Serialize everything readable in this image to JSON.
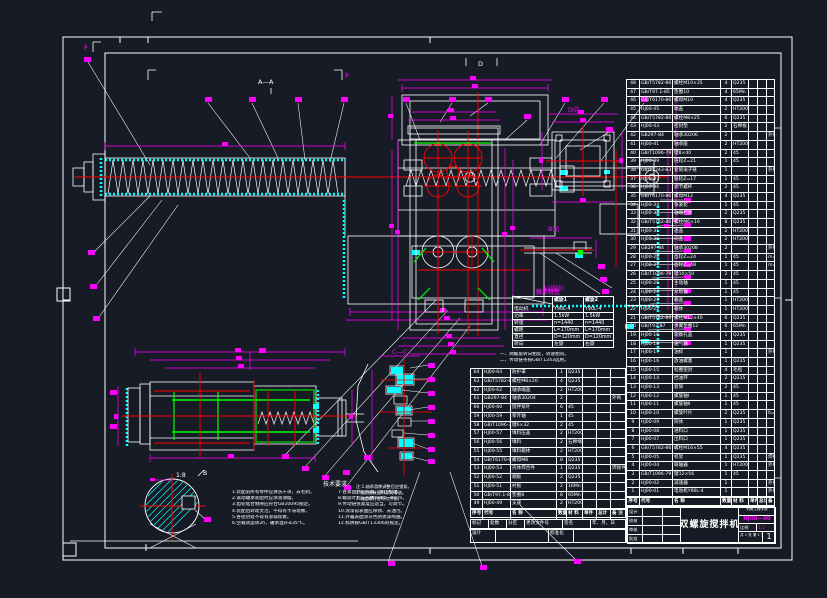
{
  "labels": {
    "section_aa": "A—A",
    "view_d_arrow": "D",
    "view_d": "D向",
    "view_b": "B向",
    "section_cc": "C—C",
    "section_f_left": "F",
    "section_f_right": "F",
    "detail_scale": "1:8",
    "view_b_mark": "B",
    "sprocket_caption": "主动链轮"
  },
  "colors": {
    "background": "#161b26",
    "line": "#ffffff",
    "dimension": "#ff00ff",
    "hatch": "#00ffff",
    "centerline": "#ff0000",
    "highlight": "#00ff00"
  },
  "tech_table": {
    "title": "技术特性",
    "header": [
      "",
      "螺旋1",
      "螺旋2"
    ],
    "rows": [
      [
        "电动机",
        "Y90L-4",
        "Y90L-4"
      ],
      [
        "功率",
        "1.5kW",
        "1.5kW"
      ],
      [
        "转速",
        "n=1440",
        "n=1440"
      ],
      [
        "螺距",
        "L=170mm",
        "L=170mm"
      ],
      [
        "直径",
        "D=120mm",
        "D=120mm"
      ],
      [
        "转向",
        "左旋",
        "右旋"
      ]
    ],
    "notes": [
      "一、两螺旋转向相反，转速相同。",
      "二、传动链条按GB/T1243选用。"
    ]
  },
  "tech_req": {
    "title": "技术要求",
    "left": [
      "1.装配前所有零件应清洗干净，去毛刺。",
      "2.滚动轴承装配时应涂润滑脂。",
      "3.齿轮啮合侧隙应符合GB10095规定。",
      "4.装配后转动灵活，不得有卡滞现象。",
      "5.各密封处不得有渗漏现象。",
      "6.空载试运转2h，轴承温升≤35℃。"
    ],
    "right": [
      "7.各紧固件应拧紧，防止松动。",
      "8.螺旋叶片与壳体间隙5~8mm。",
      "9.传动链张紧度应适当，可调节。",
      "10.涂漆前表面应除锈、去油污。",
      "11.外露表面涂灰色防锈漆两遍。",
      "12.标牌按GB/T13306的规定。"
    ]
  },
  "cc_notes": [
    "注:1.轴承游隙调整后应锁紧。",
    "2.密封圈装配时涂润滑油。",
    "3.端盖螺钉应均匀拧紧。"
  ],
  "tables": {
    "headers": [
      "序号",
      "代号",
      "名  称",
      "数量",
      "材 料",
      "单件",
      "总计",
      "备 注"
    ],
    "bom_right": {
      "rows": [
        [
          "48",
          "GB/T5782-86",
          "螺栓M10×35",
          "4",
          "Q235",
          "",
          "",
          ""
        ],
        [
          "47",
          "GB/T97.1-85",
          "垫圈10",
          "4",
          "65Mn",
          "",
          "",
          ""
        ],
        [
          "46",
          "GB/T6170-86",
          "螺母M10",
          "4",
          "Q235",
          "",
          "",
          ""
        ],
        [
          "45",
          "HJ00-45",
          "端盖",
          "2",
          "HT200",
          "",
          "",
          ""
        ],
        [
          "44",
          "GB/T5782-86",
          "螺栓M8×25",
          "6",
          "Q235",
          "",
          "",
          ""
        ],
        [
          "43",
          "HJ00-43",
          "密封垫",
          "2",
          "石棉板",
          "",
          "",
          ""
        ],
        [
          "42",
          "GB297-84",
          "轴承30206",
          "2",
          "",
          "",
          "",
          "外购"
        ],
        [
          "41",
          "HJ00-41",
          "轴承座",
          "2",
          "HT200",
          "",
          "",
          ""
        ],
        [
          "40",
          "GB/T1096-79",
          "键8×40",
          "2",
          "45",
          "",
          "",
          ""
        ],
        [
          "39",
          "HJ00-39",
          "链轮Z=21",
          "1",
          "45",
          "",
          "",
          ""
        ],
        [
          "38",
          "GB/T1243-83",
          "套筒滚子链",
          "1",
          "",
          "",
          "",
          "外购"
        ],
        [
          "37",
          "HJ00-37",
          "链轮Z=17",
          "1",
          "45",
          "",
          "",
          ""
        ],
        [
          "36",
          "HJ00-36",
          "调节螺杆",
          "2",
          "45",
          "",
          "",
          ""
        ],
        [
          "35",
          "GB/T6170-86",
          "螺母M12",
          "4",
          "Q235",
          "",
          "",
          ""
        ],
        [
          "34",
          "HJ00-34",
          "张紧轮",
          "1",
          "45",
          "",
          "",
          ""
        ],
        [
          "33",
          "HJ00-33",
          "轴端挡圈",
          "2",
          "Q235",
          "",
          "",
          ""
        ],
        [
          "32",
          "GB/T5782-86",
          "螺栓M6×16",
          "8",
          "Q235",
          "",
          "",
          ""
        ],
        [
          "31",
          "HJ00-31",
          "透盖",
          "2",
          "HT200",
          "",
          "",
          ""
        ],
        [
          "30",
          "HJ00-30",
          "闷盖",
          "2",
          "HT200",
          "",
          "",
          ""
        ],
        [
          "29",
          "GB297-84",
          "轴承30208",
          "2",
          "",
          "",
          "",
          "外购"
        ],
        [
          "28",
          "HJ00-28",
          "齿轮Z=24",
          "1",
          "45",
          "",
          "",
          "m=3"
        ],
        [
          "27",
          "HJ00-27",
          "齿轮Z=48",
          "1",
          "45",
          "",
          "",
          "m=3"
        ],
        [
          "26",
          "GB/T1096-79",
          "键10×50",
          "2",
          "45",
          "",
          "",
          ""
        ],
        [
          "25",
          "HJ00-25",
          "主动轴",
          "1",
          "45",
          "",
          "",
          ""
        ],
        [
          "24",
          "HJ00-24",
          "从动轴",
          "1",
          "45",
          "",
          "",
          ""
        ],
        [
          "23",
          "HJ00-23",
          "箱盖",
          "1",
          "HT200",
          "",
          "",
          ""
        ],
        [
          "22",
          "HJ00-22",
          "箱体",
          "1",
          "HT200",
          "",
          "",
          ""
        ],
        [
          "21",
          "GB/T5782-86",
          "螺栓M12×40",
          "6",
          "Q235",
          "",
          "",
          ""
        ],
        [
          "20",
          "GB/T93-87",
          "弹簧垫圈12",
          "6",
          "65Mn",
          "",
          "",
          ""
        ],
        [
          "19",
          "HJ00-19",
          "观察孔盖",
          "1",
          "Q235",
          "",
          "",
          ""
        ],
        [
          "18",
          "HJ00-18",
          "通气器",
          "1",
          "Q235",
          "",
          "",
          ""
        ],
        [
          "17",
          "HJ00-17",
          "油标",
          "1",
          "",
          "",
          "",
          "外购"
        ],
        [
          "16",
          "HJ00-16",
          "放油螺塞",
          "1",
          "Q235",
          "",
          "",
          ""
        ],
        [
          "15",
          "HJ00-15",
          "毡圈密封",
          "4",
          "毛毡",
          "",
          "",
          ""
        ],
        [
          "14",
          "HJ00-14",
          "挡油环",
          "2",
          "Q235",
          "",
          "",
          ""
        ],
        [
          "13",
          "HJ00-13",
          "套筒",
          "2",
          "45",
          "",
          "",
          ""
        ],
        [
          "12",
          "HJ00-12",
          "螺旋轴Ⅰ",
          "1",
          "45",
          "",
          "",
          ""
        ],
        [
          "11",
          "HJ00-11",
          "螺旋轴Ⅱ",
          "1",
          "45",
          "",
          "",
          ""
        ],
        [
          "10",
          "HJ00-10",
          "螺旋叶片",
          "2",
          "Q235",
          "",
          "",
          "δ=4"
        ],
        [
          "9",
          "HJ00-09",
          "筒体",
          "1",
          "Q235",
          "",
          "",
          ""
        ],
        [
          "8",
          "HJ00-08",
          "进料口",
          "1",
          "Q235",
          "",
          "",
          ""
        ],
        [
          "7",
          "HJ00-07",
          "出料口",
          "1",
          "Q235",
          "",
          "",
          ""
        ],
        [
          "6",
          "GB/T5782-86",
          "螺栓M16×55",
          "4",
          "Q235",
          "",
          "",
          ""
        ],
        [
          "5",
          "HJ00-05",
          "机架",
          "1",
          "Q235",
          "",
          "",
          "焊接件"
        ],
        [
          "4",
          "HJ00-04",
          "联轴器",
          "1",
          "HT200",
          "",
          "",
          "外购"
        ],
        [
          "3",
          "GB/T1096-79",
          "键12×56",
          "1",
          "45",
          "",
          "",
          ""
        ],
        [
          "2",
          "HJ00-02",
          "减速器",
          "1",
          "",
          "",
          "",
          "外购"
        ],
        [
          "1",
          "HJ00-01",
          "电动机Y90L-4",
          "1",
          "",
          "",
          "",
          "外购"
        ]
      ]
    },
    "bom_left": {
      "rows": [
        [
          "64",
          "HJ00-64",
          "防护罩",
          "1",
          "Q235",
          "",
          "",
          ""
        ],
        [
          "63",
          "GB/T5782-86",
          "螺栓M8×20",
          "4",
          "Q235",
          "",
          "",
          ""
        ],
        [
          "62",
          "HJ00-62",
          "轴承端盖",
          "2",
          "HT200",
          "",
          "",
          ""
        ],
        [
          "61",
          "GB297-84",
          "轴承30204",
          "2",
          "",
          "",
          "",
          "外购"
        ],
        [
          "60",
          "HJ00-60",
          "搅拌桨叶",
          "6",
          "45",
          "",
          "",
          ""
        ],
        [
          "59",
          "HJ00-59",
          "桨叶轴",
          "1",
          "45",
          "",
          "",
          ""
        ],
        [
          "58",
          "GB/T1096-79",
          "键6×32",
          "2",
          "45",
          "",
          "",
          ""
        ],
        [
          "57",
          "HJ00-57",
          "填料压盖",
          "2",
          "HT200",
          "",
          "",
          ""
        ],
        [
          "56",
          "HJ00-56",
          "填料",
          "2",
          "石棉绳",
          "",
          "",
          ""
        ],
        [
          "55",
          "HJ00-55",
          "填料箱体",
          "2",
          "HT200",
          "",
          "",
          ""
        ],
        [
          "54",
          "GB/T6170-86",
          "螺母M8",
          "8",
          "Q235",
          "",
          "",
          ""
        ],
        [
          "53",
          "HJ00-53",
          "壳体焊合件",
          "1",
          "Q235",
          "",
          "",
          "焊接件"
        ],
        [
          "52",
          "HJ00-52",
          "端板",
          "2",
          "Q235",
          "",
          "",
          ""
        ],
        [
          "51",
          "HJ00-51",
          "衬板",
          "2",
          "16Mn",
          "",
          "",
          ""
        ],
        [
          "50",
          "GB/T97.1-85",
          "垫圈8",
          "8",
          "65Mn",
          "",
          "",
          ""
        ],
        [
          "49",
          "HJ00-49",
          "支座",
          "2",
          "HT200",
          "",
          "",
          ""
        ]
      ]
    }
  },
  "revision": [
    "标记",
    "处数",
    "分区",
    "更改文件号",
    "签名",
    "年、月、日"
  ],
  "title_block": {
    "design": "设计",
    "check": "校核",
    "review": "审核",
    "approve": "批准",
    "standard": "标准化",
    "stage_label": "阶段标记",
    "weight_label": "重量",
    "scale_label": "比例",
    "scale": "1:2",
    "qty": "1",
    "sheet": "共 1 张 第 1 张",
    "title": "双螺旋搅拌机",
    "drawing_no": "HJ00—00",
    "org": "机械工程学院"
  }
}
